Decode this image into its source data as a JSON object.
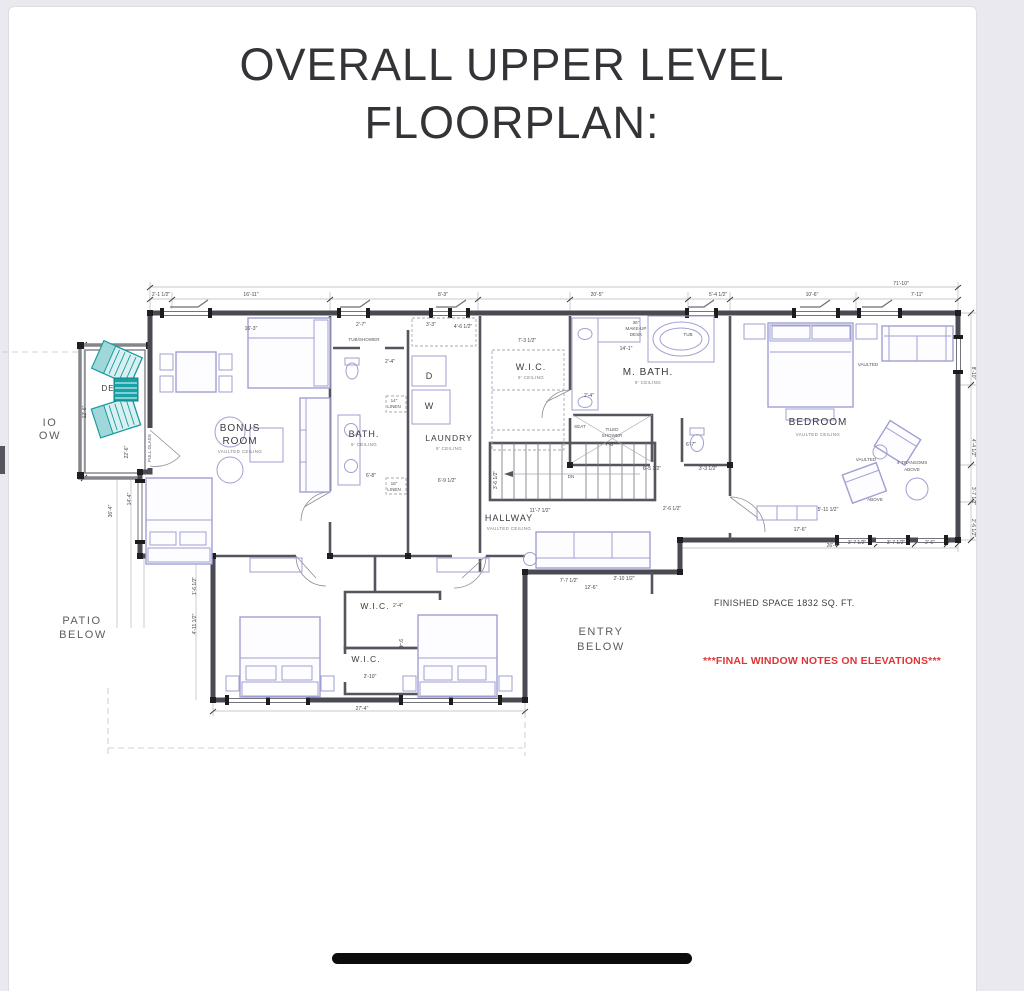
{
  "page": {
    "title_line1": "OVERALL UPPER LEVEL",
    "title_line2": "FLOORPLAN:"
  },
  "colors": {
    "page_background": "#ffffff",
    "margin_background": "#e9e9ef",
    "wall": "#4a4a52",
    "furniture": "#9fa0d2",
    "deck_accent": "#17a2a8",
    "note_red": "#e23434",
    "home_indicator": "#0c0c0c"
  },
  "floorplan": {
    "finished_space": "FINISHED SPACE 1832 SQ. FT.",
    "window_note": "***FINAL WINDOW NOTES ON ELEVATIONS***",
    "texts": [
      {
        "t": "BONUS",
        "x": 240,
        "y": 431,
        "c": "room"
      },
      {
        "t": "ROOM",
        "x": 240,
        "y": 444,
        "c": "room"
      },
      {
        "t": "BATH.",
        "x": 364,
        "y": 437,
        "c": "room",
        "s": 9
      },
      {
        "t": "LAUNDRY",
        "x": 449,
        "y": 441,
        "c": "room",
        "s": 8.5
      },
      {
        "t": "W.I.C.",
        "x": 531,
        "y": 370,
        "c": "room",
        "s": 9
      },
      {
        "t": "M. BATH.",
        "x": 648,
        "y": 375,
        "c": "room"
      },
      {
        "t": "BEDROOM",
        "x": 818,
        "y": 425,
        "c": "room"
      },
      {
        "t": "HALLWAY",
        "x": 509,
        "y": 521,
        "c": "room",
        "s": 9
      },
      {
        "t": "W.I.C.",
        "x": 375,
        "y": 609,
        "c": "room",
        "s": 8.5
      },
      {
        "t": "W.I.C.",
        "x": 366,
        "y": 662,
        "c": "room",
        "s": 8.5
      },
      {
        "t": "DE",
        "x": 108,
        "y": 391,
        "c": "room",
        "s": 8
      },
      {
        "t": "D",
        "x": 429,
        "y": 379,
        "c": "wd"
      },
      {
        "t": "W",
        "x": 429,
        "y": 409,
        "c": "wd"
      },
      {
        "t": "PATIO",
        "x": 82,
        "y": 624,
        "c": "gray"
      },
      {
        "t": "BELOW",
        "x": 83,
        "y": 638,
        "c": "gray"
      },
      {
        "t": "ENTRY",
        "x": 601,
        "y": 635,
        "c": "gray"
      },
      {
        "t": "BELOW",
        "x": 601,
        "y": 650,
        "c": "gray"
      },
      {
        "t": "IO",
        "x": 50,
        "y": 426,
        "c": "gray"
      },
      {
        "t": "OW",
        "x": 50,
        "y": 439,
        "c": "gray"
      },
      {
        "t": "VAULTED CEILING",
        "x": 240,
        "y": 453,
        "c": "sub"
      },
      {
        "t": "9' CEILING",
        "x": 364,
        "y": 446,
        "c": "sub"
      },
      {
        "t": "9' CEILING",
        "x": 449,
        "y": 450,
        "c": "sub"
      },
      {
        "t": "9' CEILING",
        "x": 531,
        "y": 379,
        "c": "sub"
      },
      {
        "t": "9' CEILING",
        "x": 648,
        "y": 384,
        "c": "sub"
      },
      {
        "t": "VAULTED CEILING",
        "x": 818,
        "y": 436,
        "c": "sub"
      },
      {
        "t": "VAULTED CEILING",
        "x": 509,
        "y": 530,
        "c": "sub"
      },
      {
        "t": "TUB/SHOWER",
        "x": 364,
        "y": 341,
        "c": "fix"
      },
      {
        "t": "TILED",
        "x": 612,
        "y": 431,
        "c": "fix"
      },
      {
        "t": "SHOWER",
        "x": 612,
        "y": 437,
        "c": "fix"
      },
      {
        "t": "SEAT",
        "x": 580,
        "y": 428,
        "c": "fix"
      },
      {
        "t": "TUB",
        "x": 688,
        "y": 336,
        "c": "fix"
      },
      {
        "t": "36\"",
        "x": 636,
        "y": 324,
        "c": "fix"
      },
      {
        "t": "MAKE-UP",
        "x": 636,
        "y": 330,
        "c": "fix"
      },
      {
        "t": "DESK",
        "x": 636,
        "y": 336,
        "c": "fix"
      },
      {
        "t": "14\"",
        "x": 394,
        "y": 402,
        "c": "fix"
      },
      {
        "t": "LINEN",
        "x": 394,
        "y": 408,
        "c": "fix"
      },
      {
        "t": "16\"",
        "x": 394,
        "y": 485,
        "c": "fix"
      },
      {
        "t": "LINEN",
        "x": 394,
        "y": 491,
        "c": "fix"
      },
      {
        "t": "DN",
        "x": 571,
        "y": 478,
        "c": "fix"
      },
      {
        "t": "4' TRANSOMS",
        "x": 912,
        "y": 464,
        "c": "fix"
      },
      {
        "t": "ABOVE",
        "x": 912,
        "y": 471,
        "c": "fix"
      },
      {
        "t": "VAULTED",
        "x": 868,
        "y": 366,
        "c": "fix"
      },
      {
        "t": "VAULTED",
        "x": 866,
        "y": 461,
        "c": "fix"
      },
      {
        "t": "ABOVE",
        "x": 875,
        "y": 501,
        "c": "fix"
      },
      {
        "t": "FULL GLASS",
        "x": 151,
        "y": 448,
        "c": "fix",
        "r": -90
      },
      {
        "t": "71'-10\"",
        "x": 901,
        "y": 285,
        "c": "dim"
      },
      {
        "t": "2'-1 1/2\"",
        "x": 161,
        "y": 296,
        "c": "dim"
      },
      {
        "t": "16'-11\"",
        "x": 251,
        "y": 296,
        "c": "dim"
      },
      {
        "t": "8'-3\"",
        "x": 443,
        "y": 296,
        "c": "dim"
      },
      {
        "t": "20'-5\"",
        "x": 597,
        "y": 296,
        "c": "dim"
      },
      {
        "t": "5'-4 1/2\"",
        "x": 718,
        "y": 296,
        "c": "dim"
      },
      {
        "t": "10'-6\"",
        "x": 812,
        "y": 296,
        "c": "dim"
      },
      {
        "t": "7'-11\"",
        "x": 917,
        "y": 296,
        "c": "dim"
      },
      {
        "t": "16'-3\"",
        "x": 251,
        "y": 330,
        "c": "dim"
      },
      {
        "t": "2'-7\"",
        "x": 361,
        "y": 326,
        "c": "dim"
      },
      {
        "t": "3'-3\"",
        "x": 431,
        "y": 326,
        "c": "dim"
      },
      {
        "t": "4'-6 1/2\"",
        "x": 463,
        "y": 328,
        "c": "dim"
      },
      {
        "t": "7'-3 1/2\"",
        "x": 527,
        "y": 342,
        "c": "dim"
      },
      {
        "t": "14'-1\"",
        "x": 626,
        "y": 350,
        "c": "dim"
      },
      {
        "t": "2'-4\"",
        "x": 390,
        "y": 363,
        "c": "dim"
      },
      {
        "t": "2'-4\"",
        "x": 589,
        "y": 397,
        "c": "dim"
      },
      {
        "t": "6'-8\"",
        "x": 371,
        "y": 477,
        "c": "dim"
      },
      {
        "t": "6'-9 1/2\"",
        "x": 447,
        "y": 482,
        "c": "dim"
      },
      {
        "t": "7'-6\"",
        "x": 610,
        "y": 446,
        "c": "dim"
      },
      {
        "t": "6'-7\"",
        "x": 691,
        "y": 446,
        "c": "dim"
      },
      {
        "t": "6'-5 1/2\"",
        "x": 652,
        "y": 470,
        "c": "dim"
      },
      {
        "t": "3'-3 1/2\"",
        "x": 708,
        "y": 470,
        "c": "dim"
      },
      {
        "t": "2'-6 1/2\"",
        "x": 672,
        "y": 510,
        "c": "dim"
      },
      {
        "t": "5'-11 1/2\"",
        "x": 828,
        "y": 511,
        "c": "dim"
      },
      {
        "t": "11'-7 1/2\"",
        "x": 540,
        "y": 512,
        "c": "dim"
      },
      {
        "t": "7'-7 1/2\"",
        "x": 569,
        "y": 582,
        "c": "dim"
      },
      {
        "t": "12'-6\"",
        "x": 591,
        "y": 589,
        "c": "dim"
      },
      {
        "t": "2'-10 1/2\"",
        "x": 624,
        "y": 580,
        "c": "dim"
      },
      {
        "t": "17'-6\"",
        "x": 800,
        "y": 531,
        "c": "dim"
      },
      {
        "t": "26'-4\"",
        "x": 833,
        "y": 547,
        "c": "dim"
      },
      {
        "t": "3'-7 1/2\"",
        "x": 857,
        "y": 544,
        "c": "dim"
      },
      {
        "t": "3'-7 1/2\"",
        "x": 896,
        "y": 544,
        "c": "dim"
      },
      {
        "t": "2'-6\"",
        "x": 930,
        "y": 544,
        "c": "dim"
      },
      {
        "t": "27'-4\"",
        "x": 362,
        "y": 710,
        "c": "dim"
      },
      {
        "t": "2'-10\"",
        "x": 370,
        "y": 678,
        "c": "dim"
      },
      {
        "t": "2'-4\"",
        "x": 398,
        "y": 607,
        "c": "dim"
      },
      {
        "t": "12'-6\"",
        "x": 86,
        "y": 412,
        "c": "dim",
        "r": -90
      },
      {
        "t": "22'-6\"",
        "x": 128,
        "y": 452,
        "c": "dim",
        "r": -90
      },
      {
        "t": "14'-4\"",
        "x": 131,
        "y": 499,
        "c": "dim",
        "r": -90
      },
      {
        "t": "36'-4\"",
        "x": 112,
        "y": 511,
        "c": "dim",
        "r": -90
      },
      {
        "t": "1'-6 1/2\"",
        "x": 196,
        "y": 586,
        "c": "dim",
        "r": -90
      },
      {
        "t": "4'-11 1/2\"",
        "x": 196,
        "y": 624,
        "c": "dim",
        "r": -90
      },
      {
        "t": "3'-6 1/2\"",
        "x": 497,
        "y": 480,
        "c": "dim",
        "r": -90
      },
      {
        "t": "8'-10\"",
        "x": 972,
        "y": 373,
        "c": "dim",
        "r": 90
      },
      {
        "t": "4'-4 1/2\"",
        "x": 972,
        "y": 448,
        "c": "dim",
        "r": 90
      },
      {
        "t": "3'-7 1/2\"",
        "x": 972,
        "y": 496,
        "c": "dim",
        "r": 90
      },
      {
        "t": "2'-6 1/2\"",
        "x": 972,
        "y": 528,
        "c": "dim",
        "r": 90
      },
      {
        "t": "9'-4\"",
        "x": 399,
        "y": 644,
        "c": "dim",
        "r": 90
      }
    ]
  }
}
